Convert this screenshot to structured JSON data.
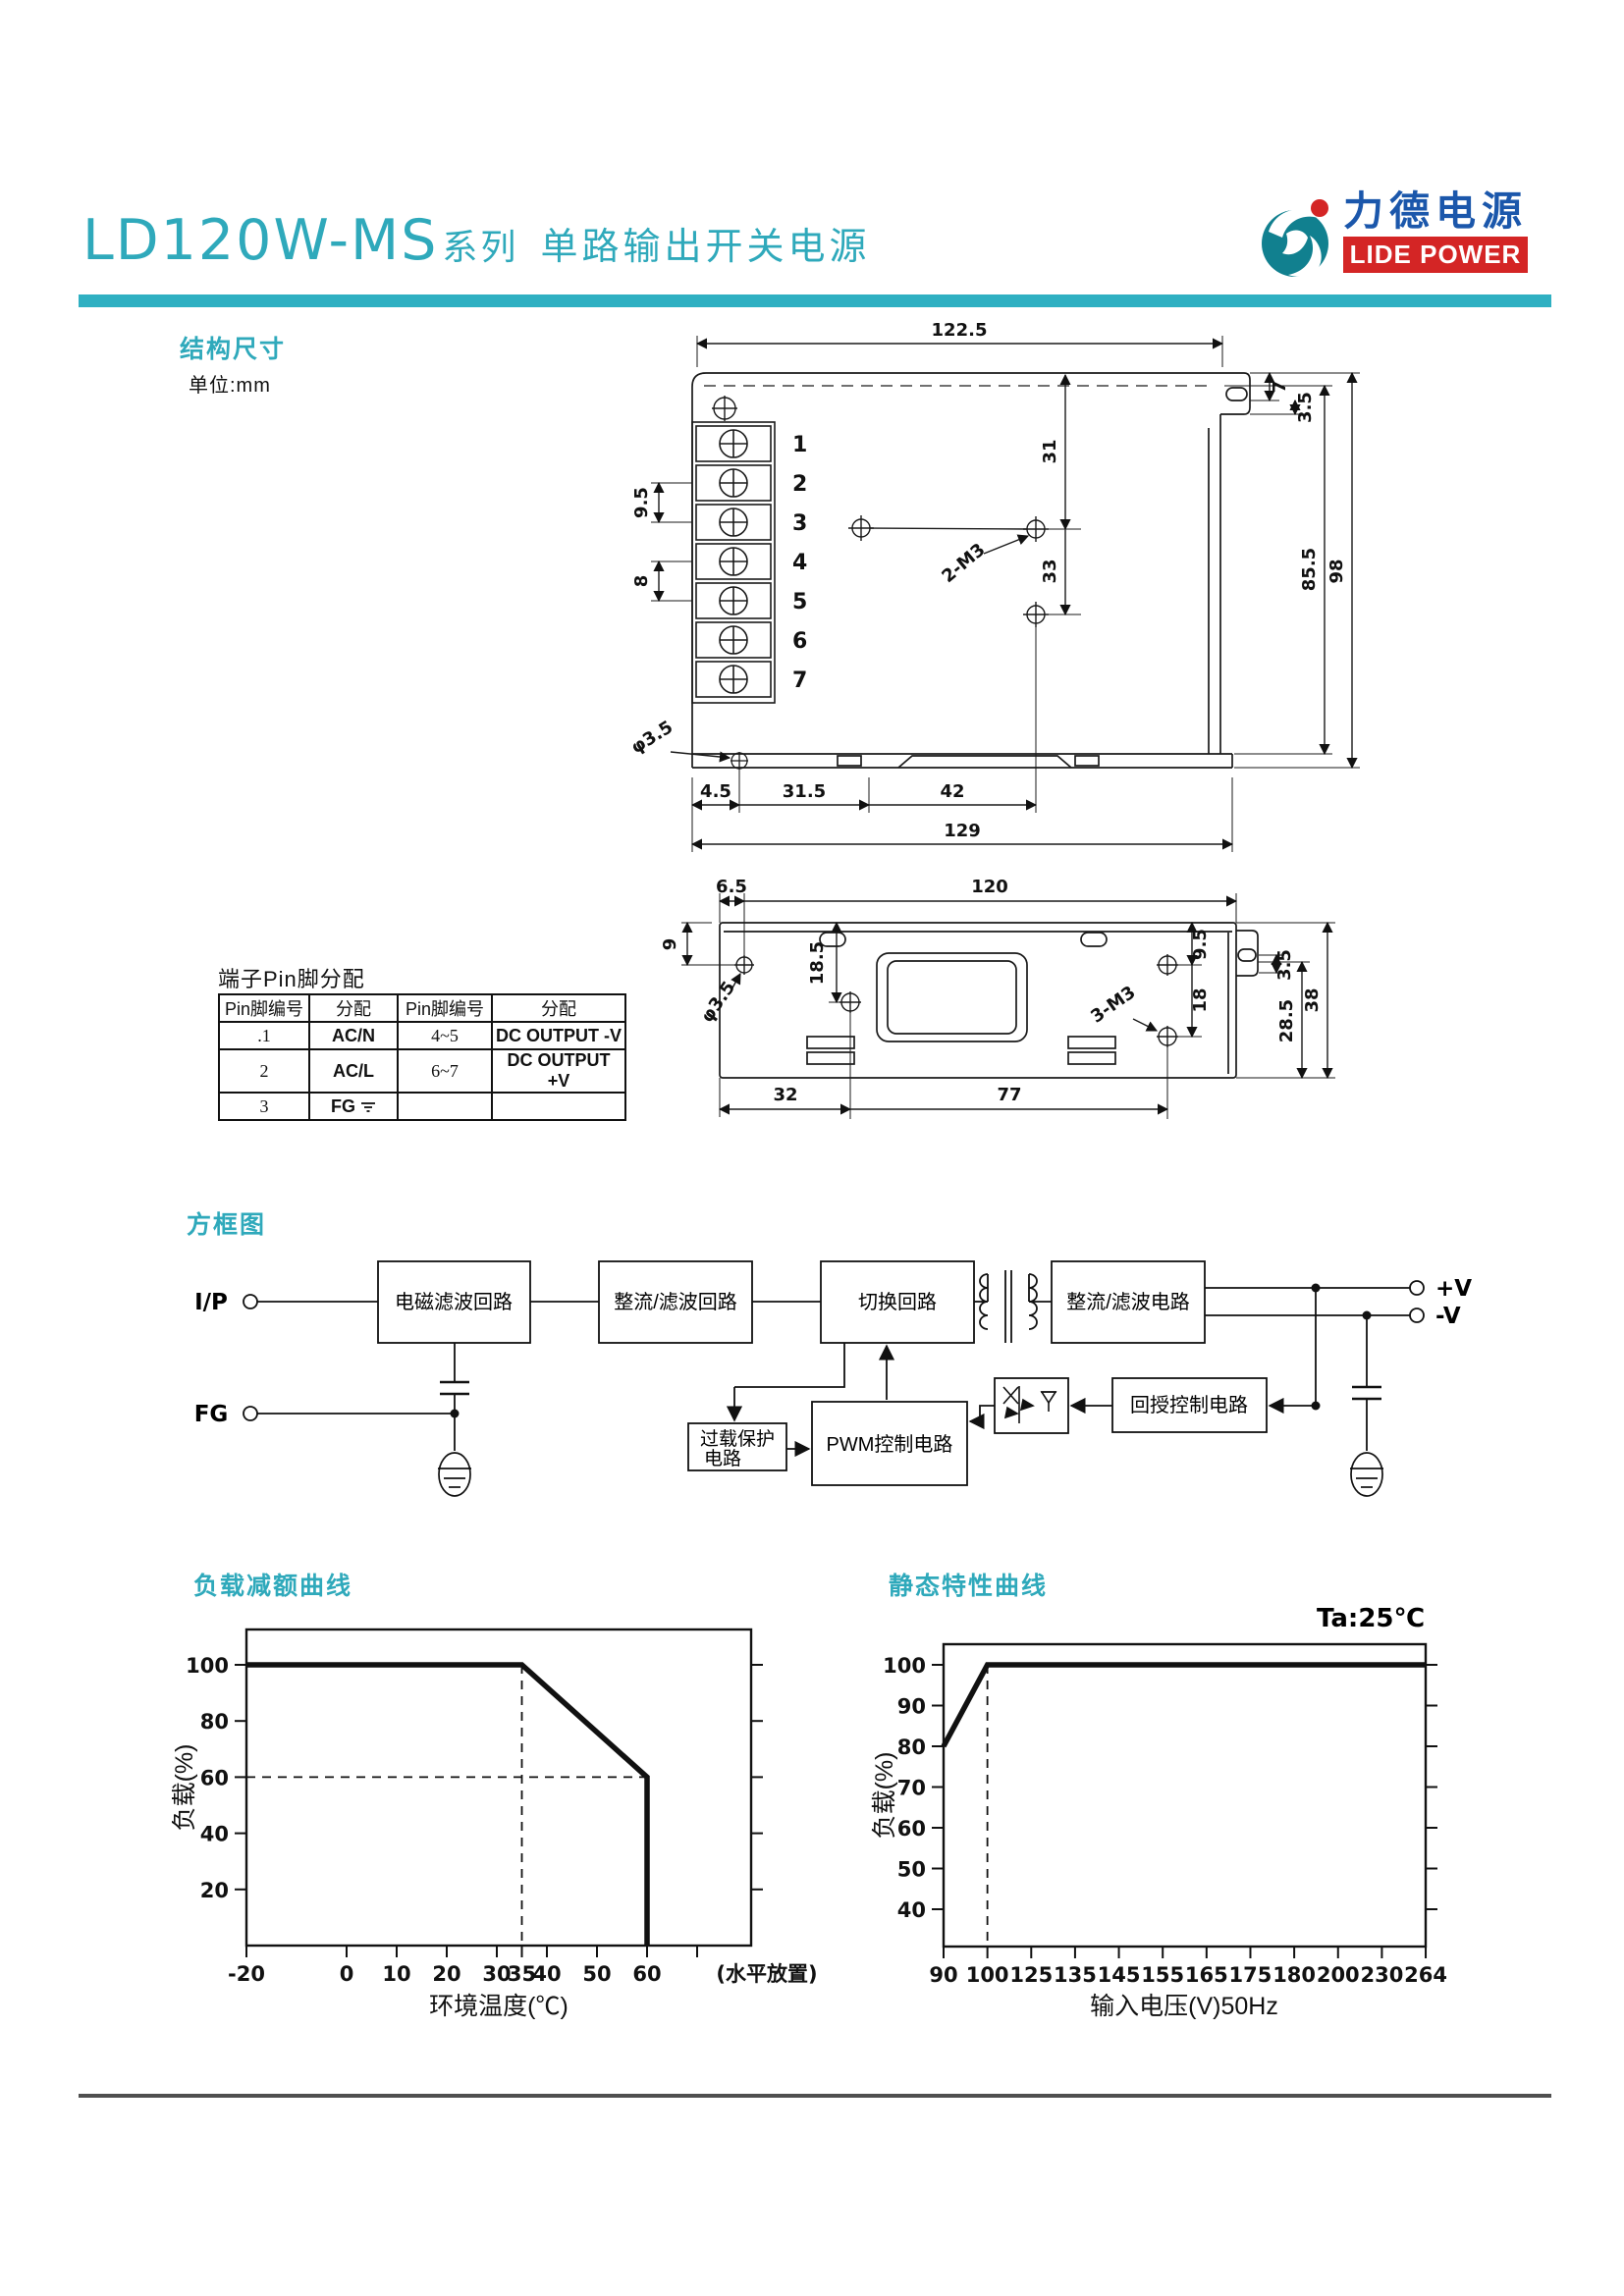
{
  "header": {
    "model": "LD120W-MS",
    "series_suffix": "系列",
    "subtitle": "单路输出开关电源",
    "logo_cn": "力德电源",
    "logo_en": "LIDE POWER",
    "accent_color": "#2fb0c2",
    "logo_blue": "#1b57ab",
    "logo_red": "#d42525"
  },
  "sections": {
    "structure": "结构尺寸",
    "unit": "单位:mm",
    "pin_title": "端子Pin脚分配",
    "block": "方框图"
  },
  "drawing_top": {
    "terminals": [
      "1",
      "2",
      "3",
      "4",
      "5",
      "6",
      "7"
    ],
    "dim_width_top": "122.5",
    "dim_tab_7": "7",
    "dim_tab_35": "3.5",
    "dim_hole_31": "31",
    "dim_hole_33": "33",
    "dim_855": "85.5",
    "dim_98": "98",
    "dim_pitch_95": "9.5",
    "dim_pitch_8": "8",
    "label_2m3": "2-M3",
    "label_hole": "φ3.5",
    "dim_45": "4.5",
    "dim_315": "31.5",
    "dim_42": "42",
    "dim_129": "129"
  },
  "drawing_bottom": {
    "dim_65": "6.5",
    "dim_120": "120",
    "dim_9": "9",
    "dim_185": "18.5",
    "label_hole": "φ3.5",
    "dim_95": "9.5",
    "dim_18": "18",
    "dim_35": "3.5",
    "dim_285": "28.5",
    "dim_38": "38",
    "label_3m3": "3-M3",
    "dim_32": "32",
    "dim_77": "77"
  },
  "pin_table": {
    "headers": [
      "Pin脚编号",
      "分配",
      "Pin脚编号",
      "分配"
    ],
    "rows": [
      [
        ".1",
        "AC/N",
        "4~5",
        "DC OUTPUT -V"
      ],
      [
        "2",
        "AC/L",
        "6~7",
        "DC OUTPUT +V"
      ],
      [
        "3",
        "FG",
        "",
        ""
      ]
    ]
  },
  "block_diagram": {
    "ip": "I/P",
    "fg": "FG",
    "emi": "电磁滤波回路",
    "rectifier_in": "整流/滤波回路",
    "switching": "切换回路",
    "rectifier_out": "整流/滤波电路",
    "overload_l1": "过载保护",
    "overload_l2": "电路",
    "pwm": "PWM控制电路",
    "feedback": "回授控制电路",
    "out_pos": "+V",
    "out_neg": "-V"
  },
  "chart_data": [
    {
      "type": "line",
      "title": "负载减额曲线",
      "xlabel": "环境温度(℃)",
      "ylabel": "负载(%)",
      "x_ticks": [
        -20,
        0,
        10,
        20,
        30,
        35,
        40,
        50,
        60
      ],
      "extra_x_ticks": [
        70
      ],
      "x_note": "(水平放置)",
      "y_ticks": [
        20,
        40,
        60,
        80,
        100
      ],
      "xlim": [
        -20,
        75
      ],
      "ylim": [
        0,
        113
      ],
      "grid": false,
      "series": [
        {
          "name": "负载",
          "points": [
            [
              -20,
              100
            ],
            [
              35,
              100
            ],
            [
              60,
              60
            ],
            [
              60,
              0
            ]
          ]
        }
      ],
      "guides": {
        "v_x": 35,
        "v_y_top": 100,
        "h_y": 60,
        "h_x_end": 60
      }
    },
    {
      "type": "line",
      "title": "静态特性曲线",
      "annotation": "Ta:25℃",
      "xlabel": "输入电压(V)50Hz",
      "ylabel": "负载(%)",
      "x_tick_labels": [
        "90",
        "100",
        "125",
        "135",
        "145",
        "155",
        "165",
        "175",
        "180",
        "200",
        "230",
        "264"
      ],
      "y_ticks": [
        40,
        50,
        60,
        70,
        80,
        90,
        100
      ],
      "ylim": [
        33,
        103
      ],
      "grid": false,
      "series": [
        {
          "name": "负载",
          "points_idx": [
            [
              0,
              80
            ],
            [
              1,
              100
            ],
            [
              11,
              100
            ]
          ]
        }
      ],
      "guides": {
        "v_idx": 1
      }
    }
  ]
}
